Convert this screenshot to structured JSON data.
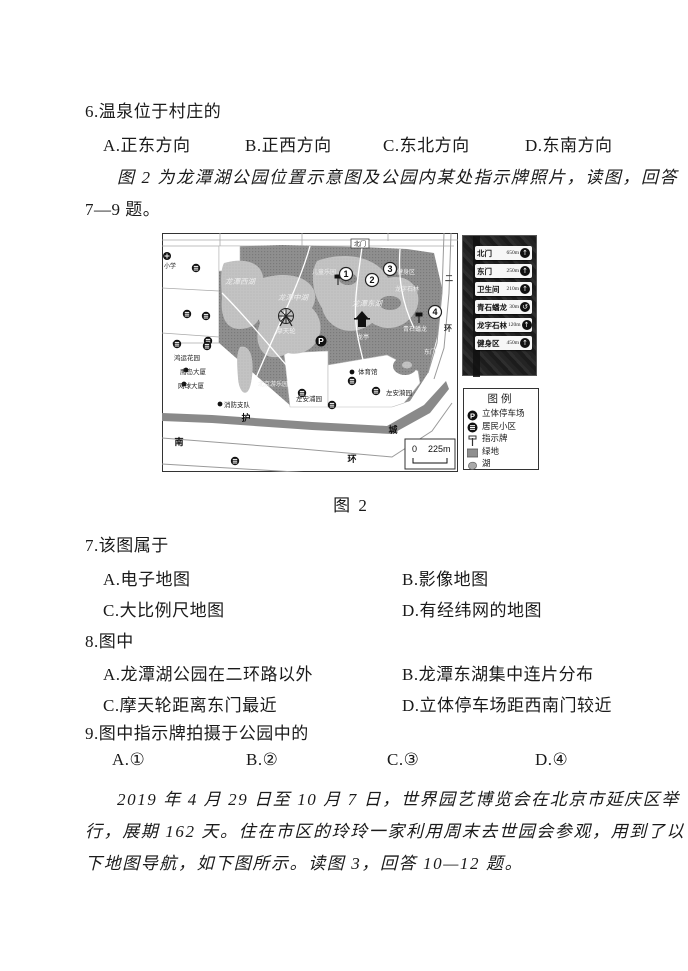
{
  "doc": {
    "q6": {
      "stem": "6.温泉位于村庄的",
      "options": [
        "A.正东方向",
        "B.正西方向",
        "C.东北方向",
        "D.东南方向"
      ]
    },
    "intro_fig2_line1": "图 2 为龙潭湖公园位置示意图及公园内某处指示牌照片，读图，回答",
    "intro_fig2_line2": "7—9 题。",
    "fig2_caption": "图 2",
    "q7": {
      "stem": "7.该图属于",
      "options": [
        "A.电子地图",
        "B.影像地图",
        "C.大比例尺地图",
        "D.有经纬网的地图"
      ]
    },
    "q8": {
      "stem": "8.图中",
      "options": [
        "A.龙潭湖公园在二环路以外",
        "B.龙潭东湖集中连片分布",
        "C.摩天轮距离东门最近",
        "D.立体停车场距西南门较近"
      ]
    },
    "q9": {
      "stem": "9.图中指示牌拍摄于公园中的",
      "options": [
        "A.①",
        "B.②",
        "C.③",
        "D.④"
      ]
    },
    "intro_fig3_lines": [
      "2019 年 4 月 29 日至 10 月 7 日，世界园艺博览会在北京市延庆区举",
      "行，展期 162 天。住在市区的玲玲一家利用周末去世园会参观，用到了以",
      "下地图导航，如下图所示。读图 3，回答 10—12 题。"
    ]
  },
  "figure": {
    "map": {
      "labels": [
        {
          "t": "小学",
          "x": 2,
          "y": 35,
          "s": 6,
          "c": "#222"
        },
        {
          "t": "龙潭西湖",
          "x": 78,
          "y": 51,
          "s": 7.5,
          "c": "#ededed",
          "a": "m",
          "i": 1
        },
        {
          "t": "龙潭中湖",
          "x": 131,
          "y": 67,
          "s": 7.5,
          "c": "#ededed",
          "a": "m",
          "i": 1
        },
        {
          "t": "龙潭东湖",
          "x": 205,
          "y": 73,
          "s": 7.5,
          "c": "#ededed",
          "a": "m",
          "i": 1
        },
        {
          "t": "摩天轮",
          "x": 124,
          "y": 100,
          "s": 6.5,
          "c": "#ededed",
          "a": "m"
        },
        {
          "t": "儿童乐园",
          "x": 162,
          "y": 41,
          "s": 6,
          "c": "#ededed",
          "a": "m"
        },
        {
          "t": "北门",
          "x": 198,
          "y": 13,
          "s": 6,
          "c": "#222",
          "a": "m"
        },
        {
          "t": "东门",
          "x": 268,
          "y": 121,
          "s": 6,
          "c": "#ededed",
          "a": "m"
        },
        {
          "t": "龙亭",
          "x": 201,
          "y": 106,
          "s": 6,
          "c": "#ededed",
          "a": "m"
        },
        {
          "t": "青石蟠龙",
          "x": 253,
          "y": 98,
          "s": 6,
          "c": "#ededed",
          "a": "m"
        },
        {
          "t": "龙字石林",
          "x": 245,
          "y": 58,
          "s": 6,
          "c": "#ededed",
          "a": "m"
        },
        {
          "t": "健身区",
          "x": 244,
          "y": 41,
          "s": 6,
          "c": "#ededed",
          "a": "m"
        },
        {
          "t": "体育馆",
          "x": 196,
          "y": 141,
          "s": 6.5,
          "c": "#222"
        },
        {
          "t": "左安浦园",
          "x": 134,
          "y": 168,
          "s": 6.5,
          "c": "#222"
        },
        {
          "t": "左安漪园",
          "x": 224,
          "y": 162,
          "s": 6.5,
          "c": "#222"
        },
        {
          "t": "北京游乐园",
          "x": 96,
          "y": 153,
          "s": 6,
          "c": "#ededed"
        },
        {
          "t": "鸿运花园",
          "x": 12,
          "y": 127,
          "s": 6.5,
          "c": "#222"
        },
        {
          "t": "鹰岛大厦",
          "x": 18,
          "y": 141,
          "s": 6.5,
          "c": "#222"
        },
        {
          "t": "网球大厦",
          "x": 16,
          "y": 155,
          "s": 6.5,
          "c": "#222"
        },
        {
          "t": "消防支队",
          "x": 62,
          "y": 174,
          "s": 6.5,
          "c": "#222"
        },
        {
          "t": "护",
          "x": 84,
          "y": 188,
          "s": 9,
          "c": "#0d0d0d",
          "a": "m",
          "w": 1
        },
        {
          "t": "城",
          "x": 231,
          "y": 200,
          "s": 9,
          "c": "#0d0d0d",
          "a": "m",
          "w": 1
        },
        {
          "t": "南",
          "x": 17,
          "y": 212,
          "s": 9,
          "c": "#0d0d0d",
          "a": "m",
          "w": 1
        },
        {
          "t": "环",
          "x": 190,
          "y": 229,
          "s": 9,
          "c": "#0d0d0d",
          "a": "m",
          "w": 1
        },
        {
          "t": "二",
          "x": 287,
          "y": 48,
          "s": 8,
          "c": "#333",
          "a": "m",
          "w": 1
        },
        {
          "t": "环",
          "x": 286,
          "y": 98,
          "s": 8,
          "c": "#333",
          "a": "m",
          "w": 1
        }
      ],
      "numbers": [
        {
          "n": "1",
          "x": 184,
          "y": 41
        },
        {
          "n": "2",
          "x": 210,
          "y": 47
        },
        {
          "n": "3",
          "x": 228,
          "y": 36
        },
        {
          "n": "4",
          "x": 273,
          "y": 79
        }
      ],
      "residential": [
        [
          34,
          35
        ],
        [
          25,
          81
        ],
        [
          44,
          83
        ],
        [
          46,
          108
        ],
        [
          15,
          111
        ],
        [
          45,
          113
        ],
        [
          140,
          160
        ],
        [
          170,
          172
        ],
        [
          214,
          158
        ],
        [
          73,
          228
        ],
        [
          190,
          148
        ]
      ],
      "dots": [
        [
          24,
          137
        ],
        [
          22,
          151
        ],
        [
          58,
          171
        ],
        [
          190,
          139
        ]
      ],
      "parking": {
        "x": 159,
        "y": 108
      },
      "scale": {
        "zero": "0",
        "dist": "225m"
      }
    },
    "sign_plates": [
      {
        "name": "北门",
        "dist": "650m",
        "arrow": "↑"
      },
      {
        "name": "东门",
        "dist": "250m",
        "arrow": "↑"
      },
      {
        "name": "卫生间",
        "dist": "210m",
        "arrow": "↑"
      },
      {
        "name": "青石蟠龙",
        "dist": "30m",
        "arrow": "↺"
      },
      {
        "name": "龙字石林",
        "dist": "120m",
        "arrow": "↑"
      },
      {
        "name": "健身区",
        "dist": "450m",
        "arrow": "↑"
      }
    ],
    "legend": {
      "title": "图例",
      "items": [
        {
          "label": "立体停车场",
          "icon": "parking"
        },
        {
          "label": "居民小区",
          "icon": "residential"
        },
        {
          "label": "指示牌",
          "icon": "signpost"
        },
        {
          "label": "绿地",
          "icon": "green"
        },
        {
          "label": "湖",
          "icon": "lake"
        }
      ]
    }
  },
  "colors": {
    "park_green": "#8f8f8f",
    "lake": "#c3c3c3",
    "moat": "#8a8a8a",
    "ink": "#1a1a1a"
  }
}
